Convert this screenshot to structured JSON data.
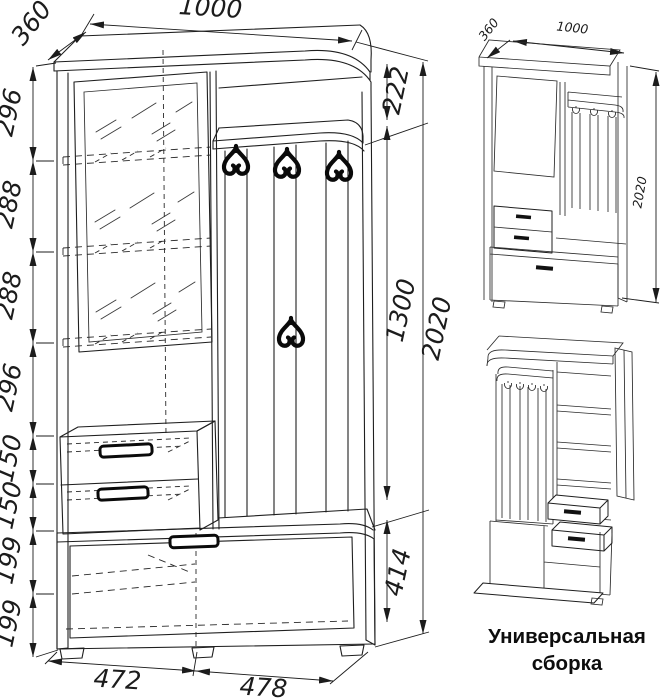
{
  "colors": {
    "line": "#1f1f1f",
    "background": "#ffffff"
  },
  "main_view": {
    "width_mm": "1000",
    "depth_mm": "360",
    "left_chain": [
      "296",
      "288",
      "288",
      "296",
      "150",
      "150",
      "199",
      "199"
    ],
    "right_chain": {
      "top_shelf": "222",
      "hook_panel": "1300",
      "base": "414",
      "total_height": "2020"
    },
    "bottom_chain": [
      "472",
      "478"
    ]
  },
  "assembly_views": {
    "front_iso": {
      "depth_mm": "360",
      "width_mm": "1000",
      "height_mm": "2020"
    },
    "caption_line1": "Универсальная",
    "caption_line2": "сборка"
  }
}
